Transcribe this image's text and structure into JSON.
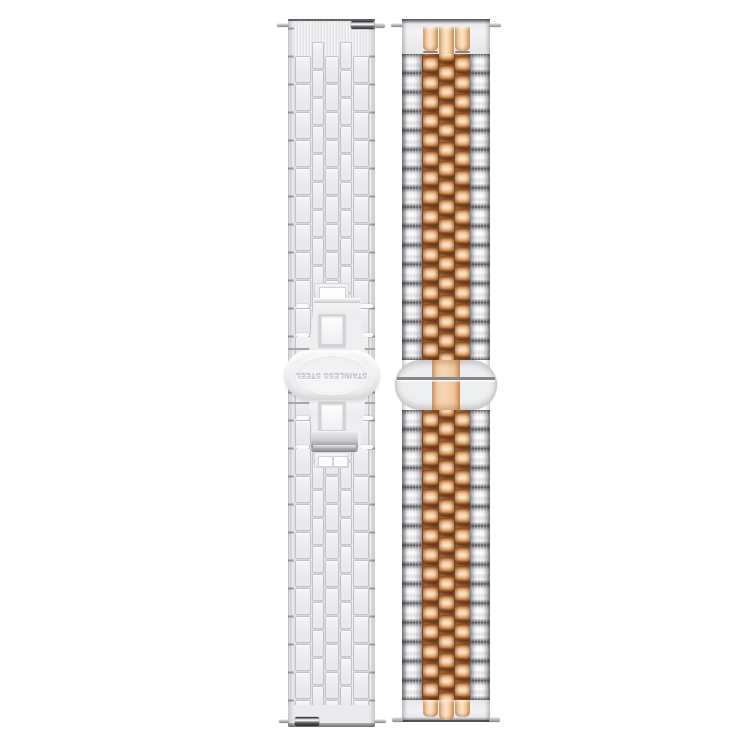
{
  "scene": {
    "type": "product-photo",
    "background_color": "#ffffff",
    "subject": "Two metal watch bands displayed vertically side by side"
  },
  "left_band": {
    "label": "silver stainless steel brick-link band with butterfly clasp",
    "engraving": "STAINLESS STEEL",
    "engraving_orientation": "rotated-180",
    "colors": {
      "base": "#ebebee",
      "brick_hi": "#f4f4f6",
      "brick_lo": "#e9e9ec",
      "brick_border": "#c2c2c7",
      "seam": "#a6a6ab",
      "edge_dark": "#6e6e73",
      "clasp_edge": "#d6d6da",
      "window_frame": "#d2d2d6",
      "window_fill": "#fdfdfe",
      "engraving_color": "#c6c6cc",
      "tab_dark": "#3a3a3f",
      "tab_light": "#d9dadd"
    }
  },
  "right_band": {
    "label": "two-tone five-row jubilee band, silver outer links, rose gold center links",
    "colors": {
      "silver_dark": "#55555b",
      "silver_mid": "#9c9ca1",
      "silver_light": "#ffffff",
      "rose_gap": "#6e3c1c",
      "rose_dark": "#8a4d22",
      "rose_light": "#fbdcba",
      "rose_pale": "#fde4c8",
      "plate": "#edeeef",
      "plate_rose": "#f6d3b2"
    }
  }
}
